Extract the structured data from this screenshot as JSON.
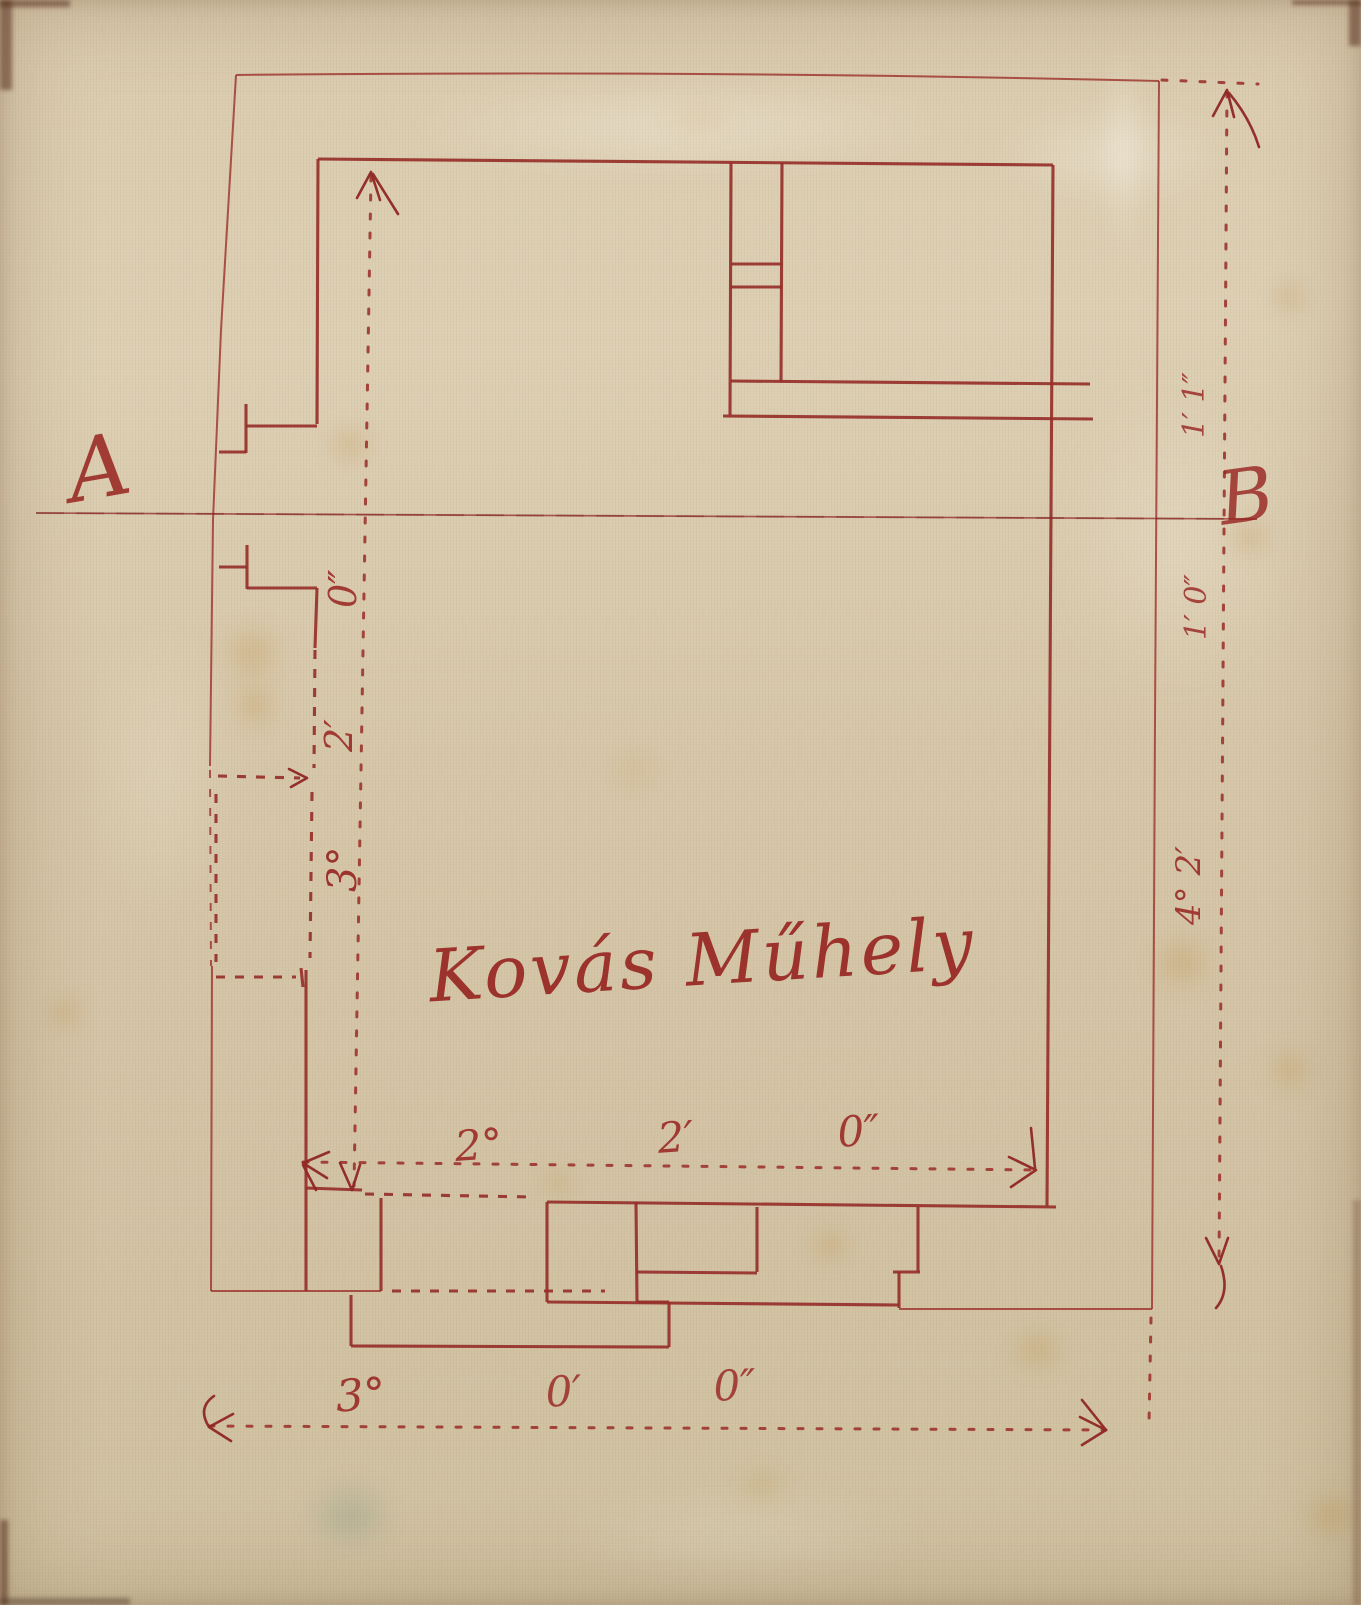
{
  "sheet": {
    "kind": "historic hand-drawn floor plan, red ink on aged tracing cloth",
    "ink_color": "#9c2d28",
    "paper_color": "#d7c7aa"
  },
  "labels": {
    "section_a": "A",
    "section_b": "B",
    "title": "Kovás Műhely"
  },
  "dimensions": {
    "bottom_exterior": [
      "3°",
      "0′",
      "0″"
    ],
    "bottom_interior": [
      "2°",
      "2′",
      "0″"
    ],
    "left_interior_bottom_to_top": [
      "3°",
      "2′",
      "0″"
    ],
    "right_exterior_top_to_bottom": [
      "1′ 1″",
      "1′ 0″",
      "4° 2′"
    ]
  }
}
